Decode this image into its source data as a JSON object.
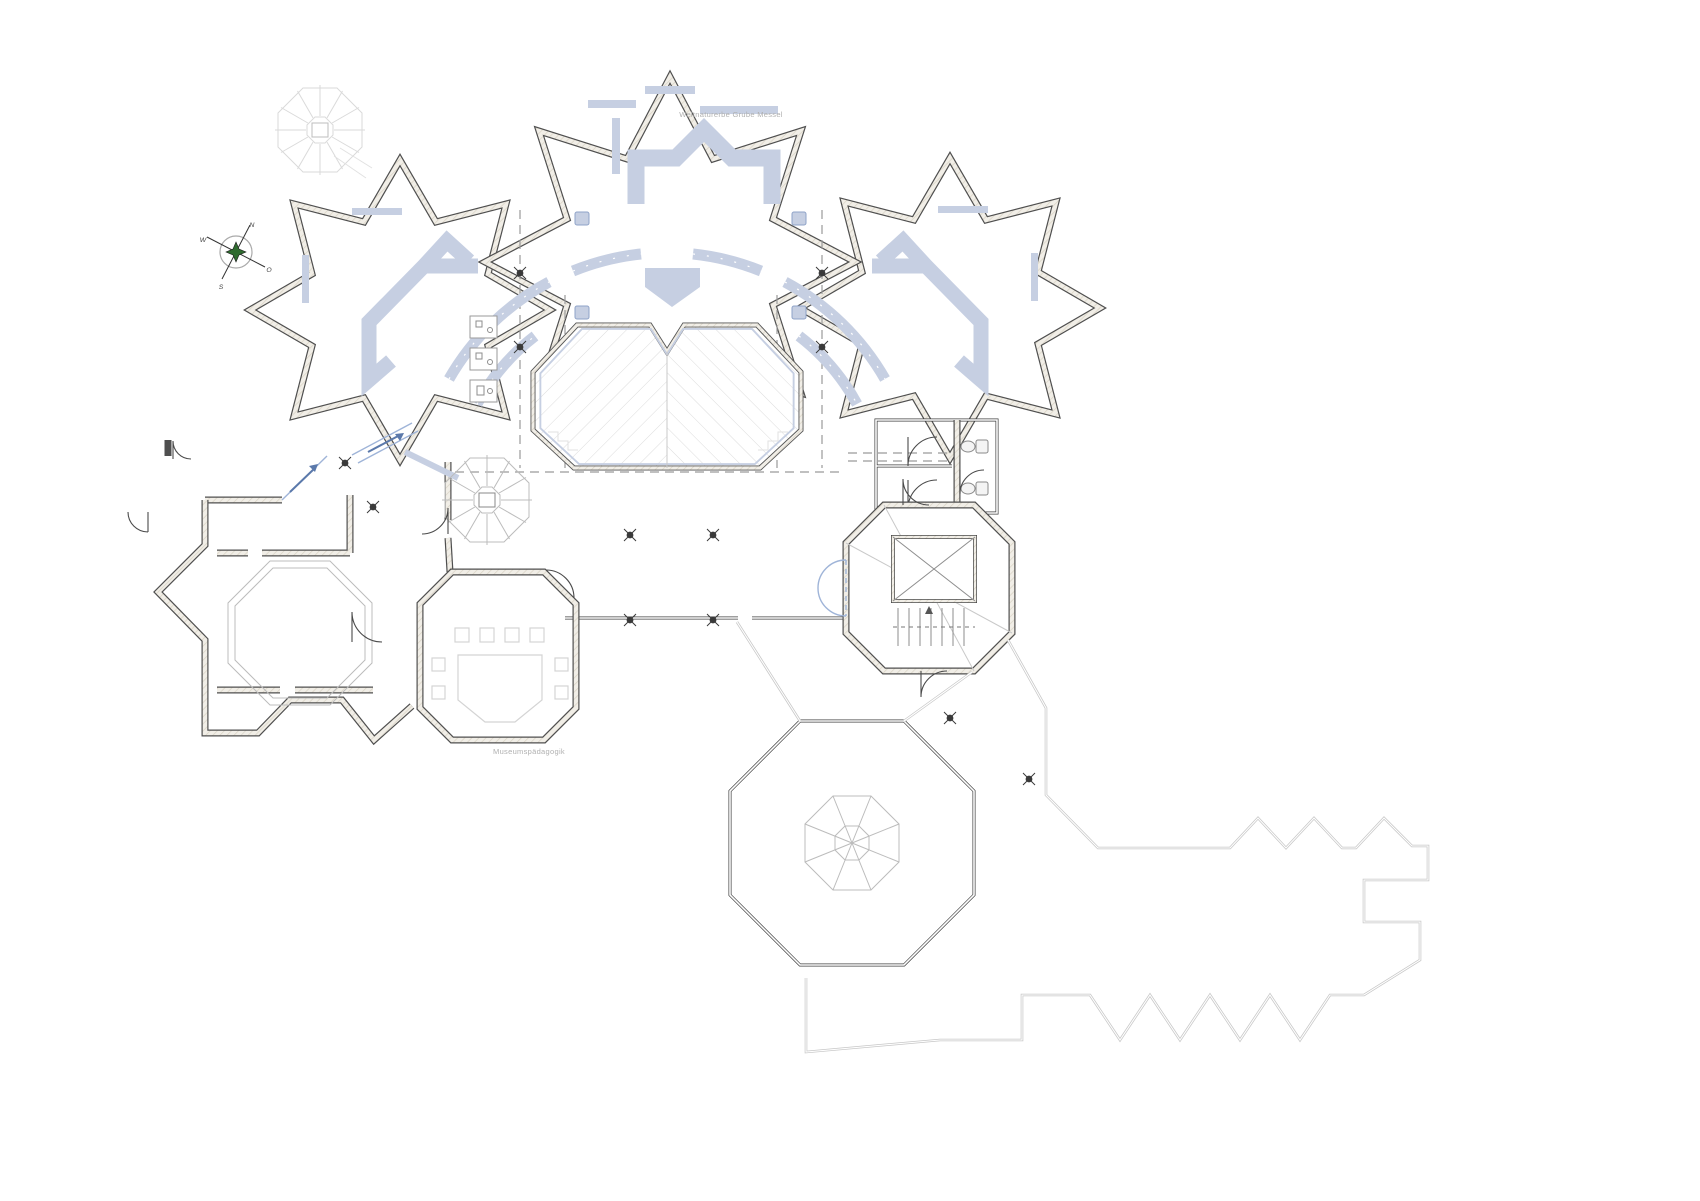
{
  "labels": {
    "site": "Weltnaturerbe Grube Messel",
    "museum_education": "Museumspädagogik"
  },
  "compass": {
    "n": "N",
    "e": "O",
    "s": "S",
    "w": "W"
  },
  "colors": {
    "exhibit_accent": "#c6cfe2",
    "accent_dark": "#5b79ab",
    "wall_dark": "#4f4f4f",
    "pit_hatch": "#dcdcdc",
    "terrace_outline": "#c7c7c7",
    "compass_green": "#2f6b2f",
    "label_gray": "#b0b0b0"
  }
}
